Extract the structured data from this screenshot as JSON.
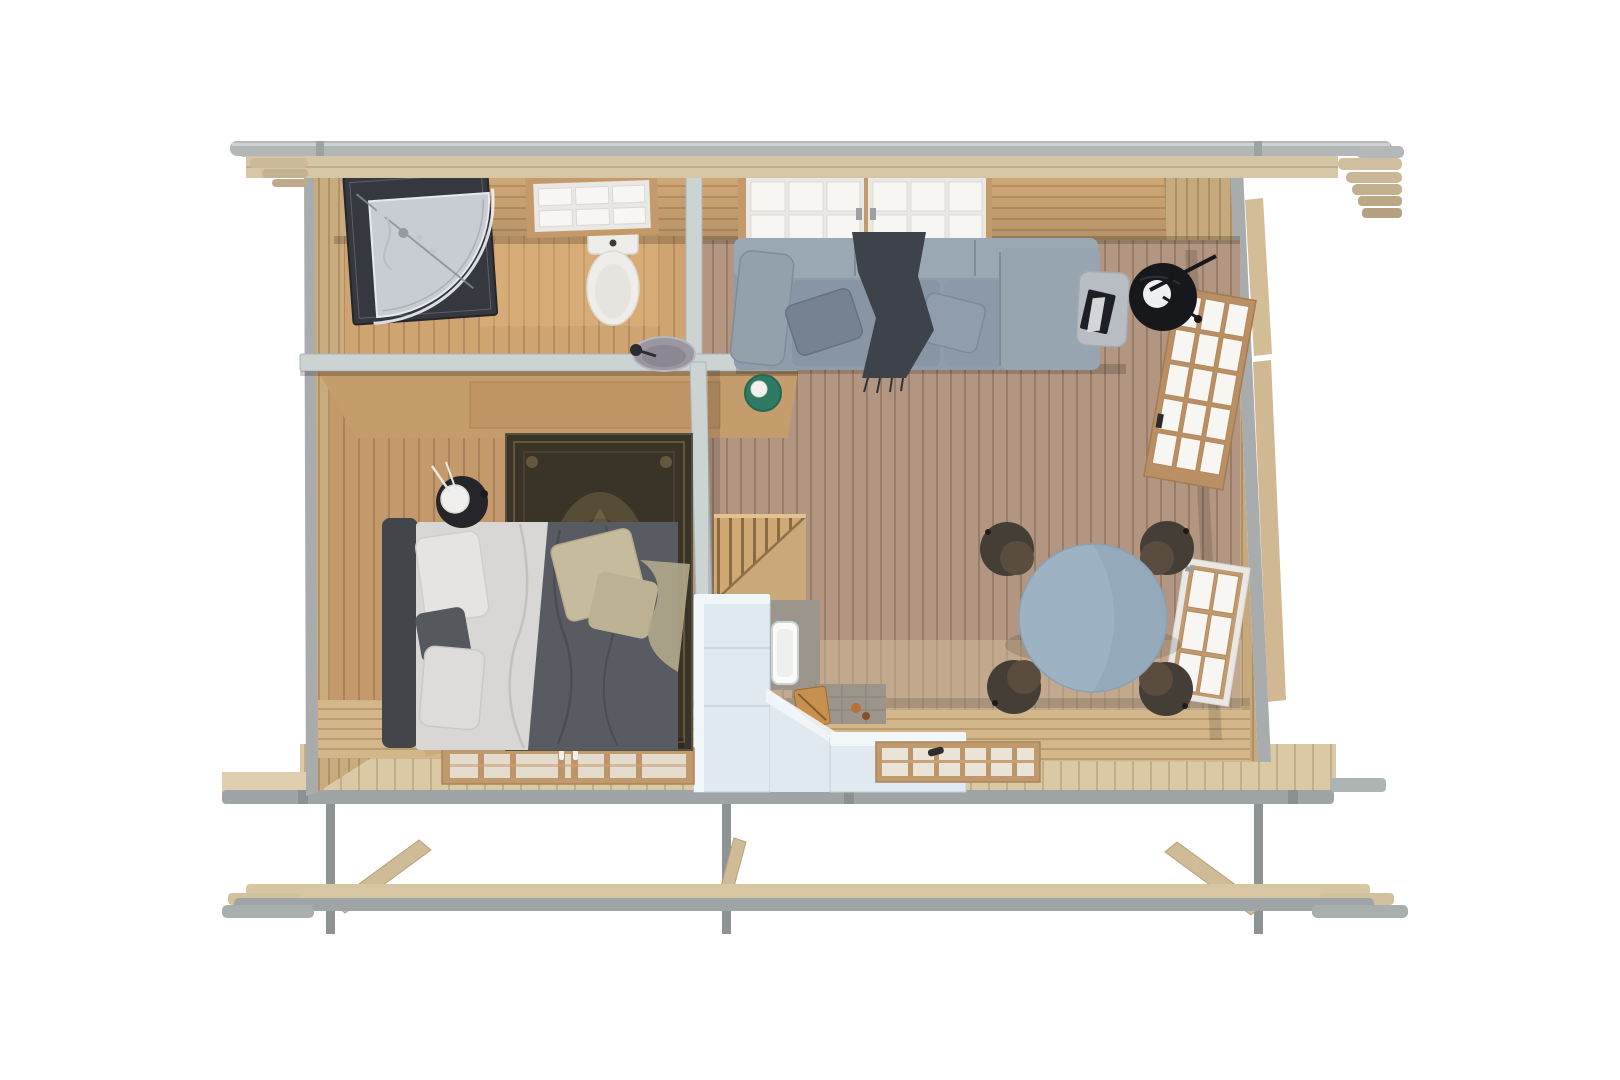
{
  "scene": {
    "title": "Top-down 3D render of a small log cabin floor plan",
    "view": "overhead cutaway",
    "rooms": [
      {
        "name": "bathroom",
        "objects": [
          "corner-shower",
          "toilet",
          "washbasin",
          "window"
        ]
      },
      {
        "name": "bedroom",
        "objects": [
          "double-bed",
          "area-rug",
          "nightstand",
          "table-lamp",
          "double-window"
        ]
      },
      {
        "name": "living-room",
        "objects": [
          "sofa",
          "chaise",
          "throw-blanket",
          "green-side-table",
          "ottoman",
          "black-side-table",
          "arc-lamp",
          "dining-table",
          "dining-chairs",
          "big-window",
          "glazed-door",
          "small-window"
        ]
      },
      {
        "name": "kitchen",
        "objects": [
          "l-shaped-counter",
          "kitchen-sink",
          "cutting-board",
          "backsplash",
          "kitchen-window",
          "staircase"
        ]
      }
    ],
    "structure": [
      "roof-edge-beam",
      "fascia-corbels",
      "log-walls",
      "partition-walls",
      "deck-boards",
      "foundation-rails",
      "foundation-posts",
      "diagonal-braces"
    ]
  },
  "palette": {
    "bg": "#ffffff",
    "roofEdgeGray": "#b3b7b8",
    "fasciaWood": "#d5c6a6",
    "partitionTop": "#ccd3d3",
    "showerDark": "#35383e",
    "showerTray": "#c7cdd3",
    "toiletWhite": "#efede9",
    "sinkBowl": "#9a97a2",
    "bedHeadboard": "#42454a",
    "bedSheet": "#d8d7d5",
    "bedDuvet": "#585c62",
    "pillowBeige": "#c7bb9e",
    "rugDark": "#3a3327",
    "nightstand": "#26262a",
    "sofa": "#8e9cab",
    "sofaLight": "#97a5b1",
    "throwDark": "#3e434b",
    "greenTable": "#2e7a63",
    "ottoman": "#b7bdc2",
    "blackTable": "#17181c",
    "diningTable": "#9db3c4",
    "chairBrown": "#453e37",
    "counter": "#e0e9ef",
    "counterTop": "#f1f6f8",
    "sinkWhite": "#fafaf8",
    "cuttingBoard": "#c6914f",
    "backsplash": "#9b958c",
    "stairsWood": "#c9a87a",
    "foundationGray": "#9fa5a7",
    "foundationWood": "#d8c6a3",
    "postGray": "#8e9394",
    "braceWood": "#cfbb96",
    "windowWood": "#c49a6b",
    "windowFrameWhite": "#e9e8e4",
    "windowPane": "#f7f6f3"
  }
}
